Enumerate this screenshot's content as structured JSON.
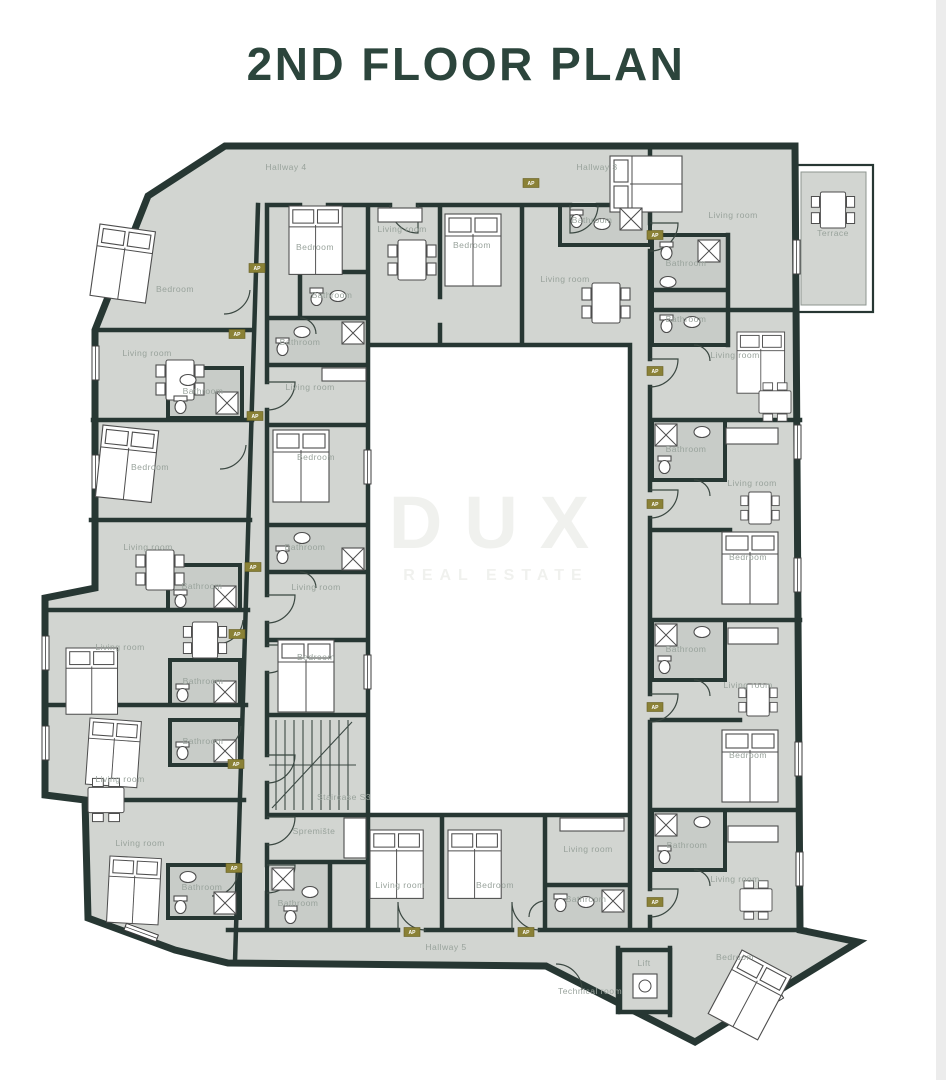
{
  "title": "2ND FLOOR PLAN",
  "watermark": {
    "brand": "DUX",
    "tagline": "REAL ESTATE"
  },
  "plan": {
    "colors": {
      "wall": "#273733",
      "floor": "#d2d5d1",
      "bathroom_floor": "#c8ccc8",
      "label": "#99a39c",
      "title": "#2c453c",
      "tag_bg": "#8a8136",
      "watermark": "#f0f1ee"
    },
    "rooms": [
      {
        "label": "Hallway 4",
        "x": 286,
        "y": 170
      },
      {
        "label": "Hallway 3",
        "x": 597,
        "y": 170
      },
      {
        "label": "Bedroom",
        "x": 315,
        "y": 250
      },
      {
        "label": "Bathroom",
        "x": 332,
        "y": 298
      },
      {
        "label": "Bathroom",
        "x": 300,
        "y": 345
      },
      {
        "label": "Living room",
        "x": 402,
        "y": 232
      },
      {
        "label": "Bedroom",
        "x": 472,
        "y": 248
      },
      {
        "label": "Bathroom",
        "x": 592,
        "y": 223
      },
      {
        "label": "Living room",
        "x": 565,
        "y": 282
      },
      {
        "label": "Living room",
        "x": 733,
        "y": 218
      },
      {
        "label": "Terrace",
        "x": 833,
        "y": 236
      },
      {
        "label": "Bathroom",
        "x": 686,
        "y": 266
      },
      {
        "label": "Bathroom",
        "x": 686,
        "y": 322
      },
      {
        "label": "Living room",
        "x": 735,
        "y": 358
      },
      {
        "label": "Bathroom",
        "x": 686,
        "y": 452
      },
      {
        "label": "Living room",
        "x": 752,
        "y": 486
      },
      {
        "label": "Bedroom",
        "x": 748,
        "y": 560
      },
      {
        "label": "Bathroom",
        "x": 686,
        "y": 652
      },
      {
        "label": "Living room",
        "x": 748,
        "y": 688
      },
      {
        "label": "Bedroom",
        "x": 748,
        "y": 758
      },
      {
        "label": "Bathroom",
        "x": 687,
        "y": 848
      },
      {
        "label": "Living room",
        "x": 735,
        "y": 882
      },
      {
        "label": "Bedroom",
        "x": 735,
        "y": 960
      },
      {
        "label": "Lift",
        "x": 644,
        "y": 966
      },
      {
        "label": "Technical room",
        "x": 590,
        "y": 994
      },
      {
        "label": "Hallway 5",
        "x": 446,
        "y": 950
      },
      {
        "label": "Living room",
        "x": 400,
        "y": 888
      },
      {
        "label": "Bedroom",
        "x": 495,
        "y": 888
      },
      {
        "label": "Living room",
        "x": 588,
        "y": 852
      },
      {
        "label": "Bathroom",
        "x": 586,
        "y": 902
      },
      {
        "label": "Staircase S3",
        "x": 344,
        "y": 800
      },
      {
        "label": "Spremište",
        "x": 314,
        "y": 834
      },
      {
        "label": "Bathroom",
        "x": 298,
        "y": 906
      },
      {
        "label": "Living room",
        "x": 310,
        "y": 390
      },
      {
        "label": "Bedroom",
        "x": 316,
        "y": 460
      },
      {
        "label": "Bathroom",
        "x": 305,
        "y": 550
      },
      {
        "label": "Living room",
        "x": 316,
        "y": 590
      },
      {
        "label": "Bedroom",
        "x": 316,
        "y": 660
      },
      {
        "label": "Bedroom",
        "x": 175,
        "y": 292
      },
      {
        "label": "Living room",
        "x": 147,
        "y": 356
      },
      {
        "label": "Bathroom",
        "x": 203,
        "y": 394
      },
      {
        "label": "Bedroom",
        "x": 150,
        "y": 470
      },
      {
        "label": "Living room",
        "x": 148,
        "y": 550
      },
      {
        "label": "Bathroom",
        "x": 202,
        "y": 589
      },
      {
        "label": "Living room",
        "x": 120,
        "y": 650
      },
      {
        "label": "Bathroom",
        "x": 203,
        "y": 684
      },
      {
        "label": "Bathroom",
        "x": 203,
        "y": 744
      },
      {
        "label": "Living room",
        "x": 120,
        "y": 782
      },
      {
        "label": "Living room",
        "x": 140,
        "y": 846
      },
      {
        "label": "Bathroom",
        "x": 202,
        "y": 890
      }
    ],
    "tags": {
      "label": "AP",
      "positions": [
        [
          531,
          183
        ],
        [
          655,
          235
        ],
        [
          655,
          371
        ],
        [
          655,
          504
        ],
        [
          655,
          707
        ],
        [
          655,
          902
        ],
        [
          412,
          932
        ],
        [
          526,
          932
        ],
        [
          257,
          268
        ],
        [
          237,
          334
        ],
        [
          255,
          416
        ],
        [
          253,
          567
        ],
        [
          237,
          634
        ],
        [
          236,
          764
        ],
        [
          234,
          868
        ]
      ]
    }
  }
}
